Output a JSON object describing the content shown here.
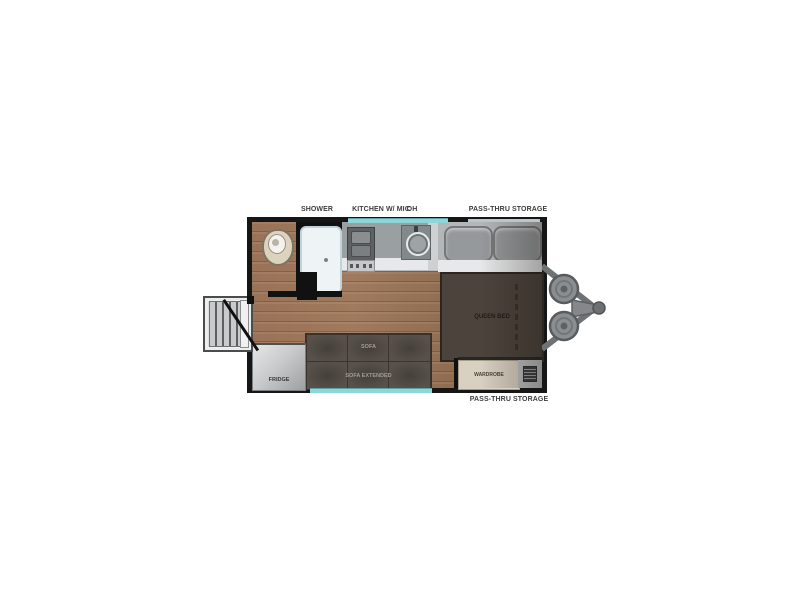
{
  "floorplan": {
    "title": "Travel trailer floor plan",
    "labels": {
      "shower": "SHOWER",
      "kitchen": "KITCHEN W/ MIC",
      "overhead": "OH",
      "pass_thru_top": "PASS-THRU STORAGE",
      "pass_thru_bottom": "PASS-THRU STORAGE",
      "queen_bed": "QUEEN BED",
      "fridge": "FRIDGE",
      "sofa": "SOFA",
      "sofa_extended": "SOFA EXTENDED",
      "wardrobe": "WARDROBE"
    },
    "colors": {
      "wall": "#161616",
      "floor_wood": "#96745a",
      "counter_gray": "#9aa0a2",
      "bed_brown": "#4c443c",
      "sofa_brown": "#57514a",
      "wardrobe_beige": "#d8d0c1",
      "window_teal": "#8fd6d8",
      "hitch_gray": "#808385"
    }
  }
}
